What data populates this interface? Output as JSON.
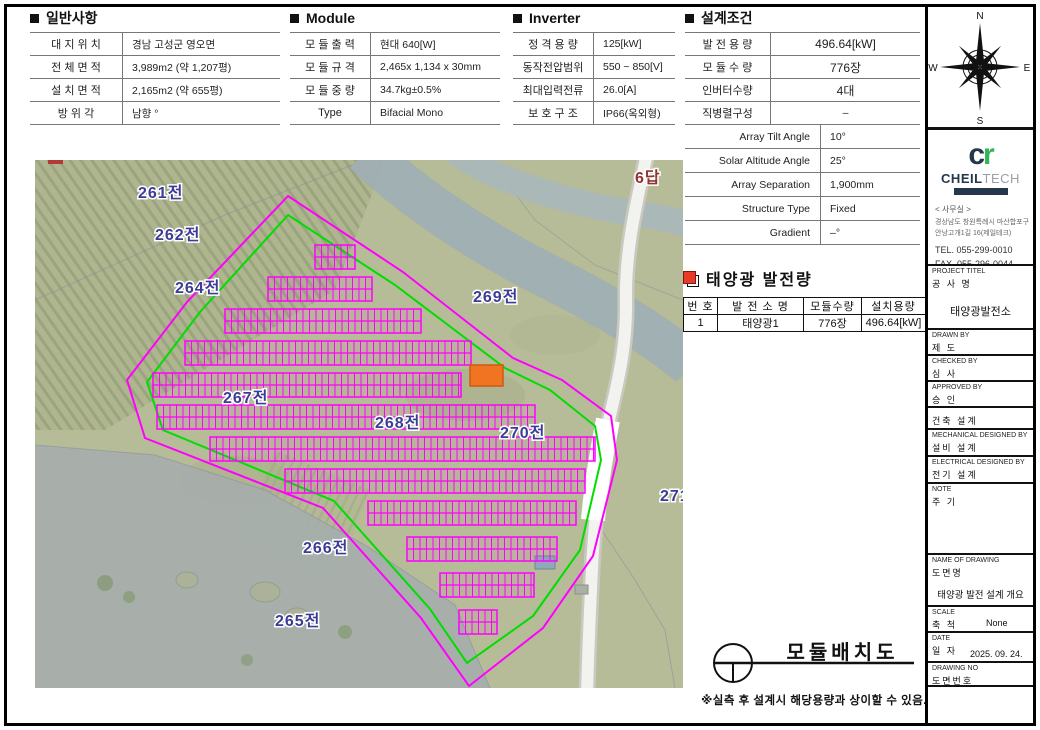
{
  "sections": {
    "general": {
      "title": "일반사항",
      "rows": [
        {
          "label": "대 지 위 치",
          "value": "경남 고성군 영오면"
        },
        {
          "label": "전 체 면 적",
          "value": "3,989m2 (약 1,207평)"
        },
        {
          "label": "설 치 면 적",
          "value": "2,165m2 (약 655평)"
        },
        {
          "label": "방  위  각",
          "value": "남향 °"
        }
      ]
    },
    "module": {
      "title": "Module",
      "rows": [
        {
          "label": "모 듈 출 력",
          "value": "현대 640[W]"
        },
        {
          "label": "모 듈 규 격",
          "value": "2,465x 1,134 x 30mm"
        },
        {
          "label": "모 듈 중 량",
          "value": "34.7kg±0.5%"
        },
        {
          "label": "Type",
          "value": "Bifacial Mono"
        }
      ]
    },
    "inverter": {
      "title": "Inverter",
      "rows": [
        {
          "label": "정 격 용 량",
          "value": "125[kW]"
        },
        {
          "label": "동작전압범위",
          "value": "550 ~ 850[V]"
        },
        {
          "label": "최대입력전류",
          "value": "26.0[A]"
        },
        {
          "label": "보 호 구 조",
          "value": "IP66(옥외형)"
        }
      ]
    },
    "design": {
      "title": "설계조건",
      "rows": [
        {
          "label": "발 전 용 량",
          "value": "496.64[kW]"
        },
        {
          "label": "모 듈 수 량",
          "value": "776장"
        },
        {
          "label": "인버터수량",
          "value": "4대"
        },
        {
          "label": "직병렬구성",
          "value": "–"
        }
      ],
      "rows2": [
        {
          "label": "Array Tilt Angle",
          "value": "10°"
        },
        {
          "label": "Solar Altitude Angle",
          "value": "25°"
        },
        {
          "label": "Array Separation",
          "value": "1,900mm"
        },
        {
          "label": "Structure Type",
          "value": "Fixed"
        },
        {
          "label": "Gradient",
          "value": "–°"
        }
      ]
    }
  },
  "generation": {
    "title": "태양광 발전량",
    "headers": [
      "번 호",
      "발 전 소 명",
      "모듈수량",
      "설치용량"
    ],
    "row": [
      "1",
      "태양광1",
      "776장",
      "496.64[kW]"
    ]
  },
  "map": {
    "labels": [
      {
        "text": "261전"
      },
      {
        "text": "262전"
      },
      {
        "text": "264전"
      },
      {
        "text": "269전"
      },
      {
        "text": "267전"
      },
      {
        "text": "268전"
      },
      {
        "text": "270전"
      },
      {
        "text": "271"
      },
      {
        "text": "266전"
      },
      {
        "text": "265전"
      },
      {
        "text": "6답"
      }
    ],
    "colors": {
      "panel": "#ff00ff",
      "boundary_inner": "#00dd00",
      "boundary_outer": "#ff00ff",
      "equipment": "#f07422",
      "label": "#3c3c96",
      "label_paddy": "#8f3333"
    }
  },
  "footer": {
    "drawing_title": "모듈배치도",
    "note": "※실측 후 설계시 해당용량과 상이할 수 있음."
  },
  "sidebar": {
    "compass": {
      "n": "N",
      "e": "E",
      "s": "S",
      "w": "W"
    },
    "logo": {
      "mark_c": "c",
      "mark_r": "r",
      "name_bold": "CHEIL",
      "name_light": "TECH"
    },
    "office": {
      "heading": "< 사무실 >",
      "address1": "경상남도 창원특례시 마산합포구",
      "address2": "안낭고개1길 16(제일테크)",
      "tel": "TEL. 055-299-0010",
      "fax": "FAX. 055-296-0044"
    },
    "titleblock": [
      {
        "en": "PROJECT TITEL",
        "ko": "공 사 명",
        "value": "태양광발전소"
      },
      {
        "en": "DRAWN BY",
        "ko": "제  도",
        "value": ""
      },
      {
        "en": "CHECKED BY",
        "ko": "심  사",
        "value": ""
      },
      {
        "en": "APPROVED BY",
        "ko": "승  인",
        "value": ""
      },
      {
        "en": "",
        "ko": "건축 설계",
        "value": ""
      },
      {
        "en": "MECHANICAL DESIGNED BY",
        "ko": "설비 설계",
        "value": ""
      },
      {
        "en": "ELECTRICAL DESIGNED BY",
        "ko": "전기 설계",
        "value": ""
      },
      {
        "en": "NOTE",
        "ko": "주 기",
        "value": ""
      },
      {
        "en": "NAME OF DRAWING",
        "ko": "도면명",
        "value": "태양광 발전 설계 개요"
      },
      {
        "en": "SCALE",
        "ko": "축  척",
        "value": "None"
      },
      {
        "en": "DATE",
        "ko": "일  자",
        "value": "2025. 09. 24."
      },
      {
        "en": "DRAWING NO",
        "ko": "도면번호",
        "value": ""
      }
    ]
  }
}
